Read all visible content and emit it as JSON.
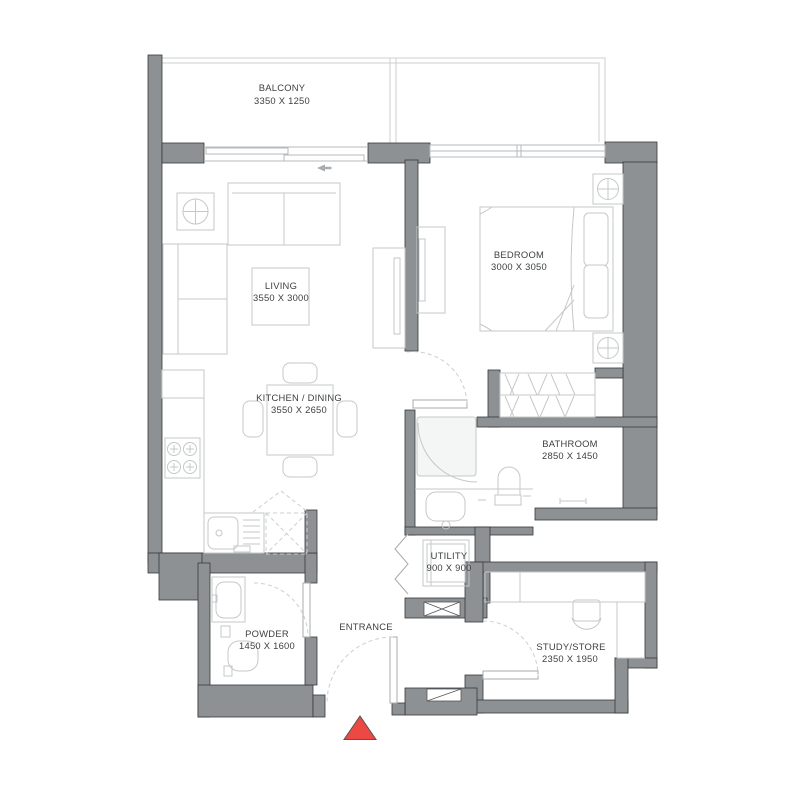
{
  "colors": {
    "wall": "#8d9193",
    "wall_edge": "#35393b",
    "furn": "#c5c8ca",
    "dash": "#cbcfd1",
    "door": "#a8acae",
    "box_edge": "#54585a",
    "balcony": "#ced1d2",
    "glass": "#b6babc",
    "text": "#3c3f41",
    "red": "#ed4842"
  },
  "rooms": [
    {
      "name": "BALCONY",
      "dims": "3350 X 1250"
    },
    {
      "name": "LIVING",
      "dims": "3550 X 3000"
    },
    {
      "name": "BEDROOM",
      "dims": "3000 X 3050"
    },
    {
      "name": "KITCHEN / DINING",
      "dims": "3550 X 2650"
    },
    {
      "name": "BATHROOM",
      "dims": "2850 X 1450"
    },
    {
      "name": "UTILITY",
      "dims": "900 X 900"
    },
    {
      "name": "POWDER",
      "dims": "1450 X 1600"
    },
    {
      "name": "STUDY/STORE",
      "dims": "2350 X 1950"
    },
    {
      "name": "ENTRANCE",
      "dims": ""
    }
  ]
}
